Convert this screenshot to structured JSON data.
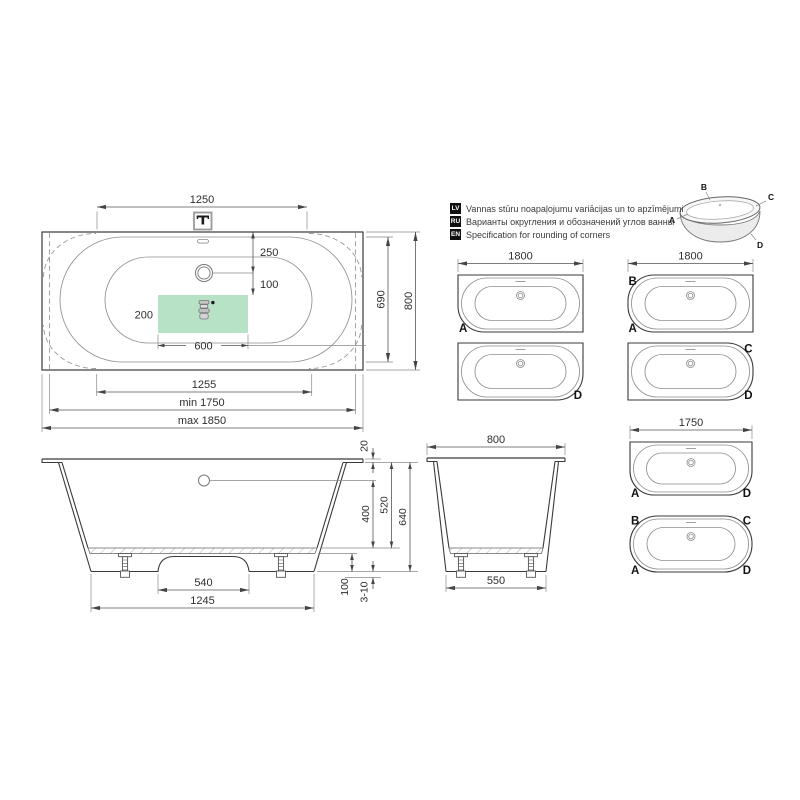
{
  "title": "Bathtub technical specification drawing",
  "legend": {
    "items": [
      {
        "lang": "LV",
        "text": "Vannas stūru noapaļojumu variācijas un to apzīmējumi"
      },
      {
        "lang": "RU",
        "text": "Варианты округления и обозначений углов ванны"
      },
      {
        "lang": "EN",
        "text": "Specification for rounding of corners"
      }
    ],
    "tub3d": {
      "a": "A",
      "b": "B",
      "c": "C",
      "d": "D"
    }
  },
  "top_view": {
    "dims": {
      "top_width": "1250",
      "drain_from_top": "250",
      "drain_to_zone": "100",
      "zone_height": "200",
      "zone_width": "600",
      "bottom_width": "1255",
      "min_length": "min 1750",
      "max_length": "max 1850",
      "inner_width": "690",
      "outer_width": "800"
    },
    "colors": {
      "zone_green": "#b7e2c6",
      "dim_red": "#e0352c"
    }
  },
  "variants": [
    {
      "dim": "1800",
      "corners": [
        {
          "label": "A"
        }
      ]
    },
    {
      "corners": [
        {
          "label": "D"
        }
      ]
    },
    {
      "dim": "1800",
      "corners": [
        {
          "label": "B"
        },
        {
          "label": "A"
        }
      ]
    },
    {
      "corners": [
        {
          "label": "C"
        },
        {
          "label": "D"
        }
      ]
    },
    {
      "dim": "1750",
      "corners": [
        {
          "label": "A"
        },
        {
          "label": "D"
        }
      ]
    },
    {
      "corners": [
        {
          "label": "B"
        },
        {
          "label": "C"
        },
        {
          "label": "A"
        },
        {
          "label": "D"
        }
      ]
    }
  ],
  "side_view": {
    "dims": {
      "arch_width": "540",
      "base_length": "1245",
      "rim_thickness": "20",
      "inner_depth": "400",
      "depth_to_rim": "520",
      "total_height": "640",
      "skirt_height": "100",
      "feet_range": "3-10"
    }
  },
  "end_view": {
    "dims": {
      "top_width": "800",
      "base_width": "550"
    }
  }
}
